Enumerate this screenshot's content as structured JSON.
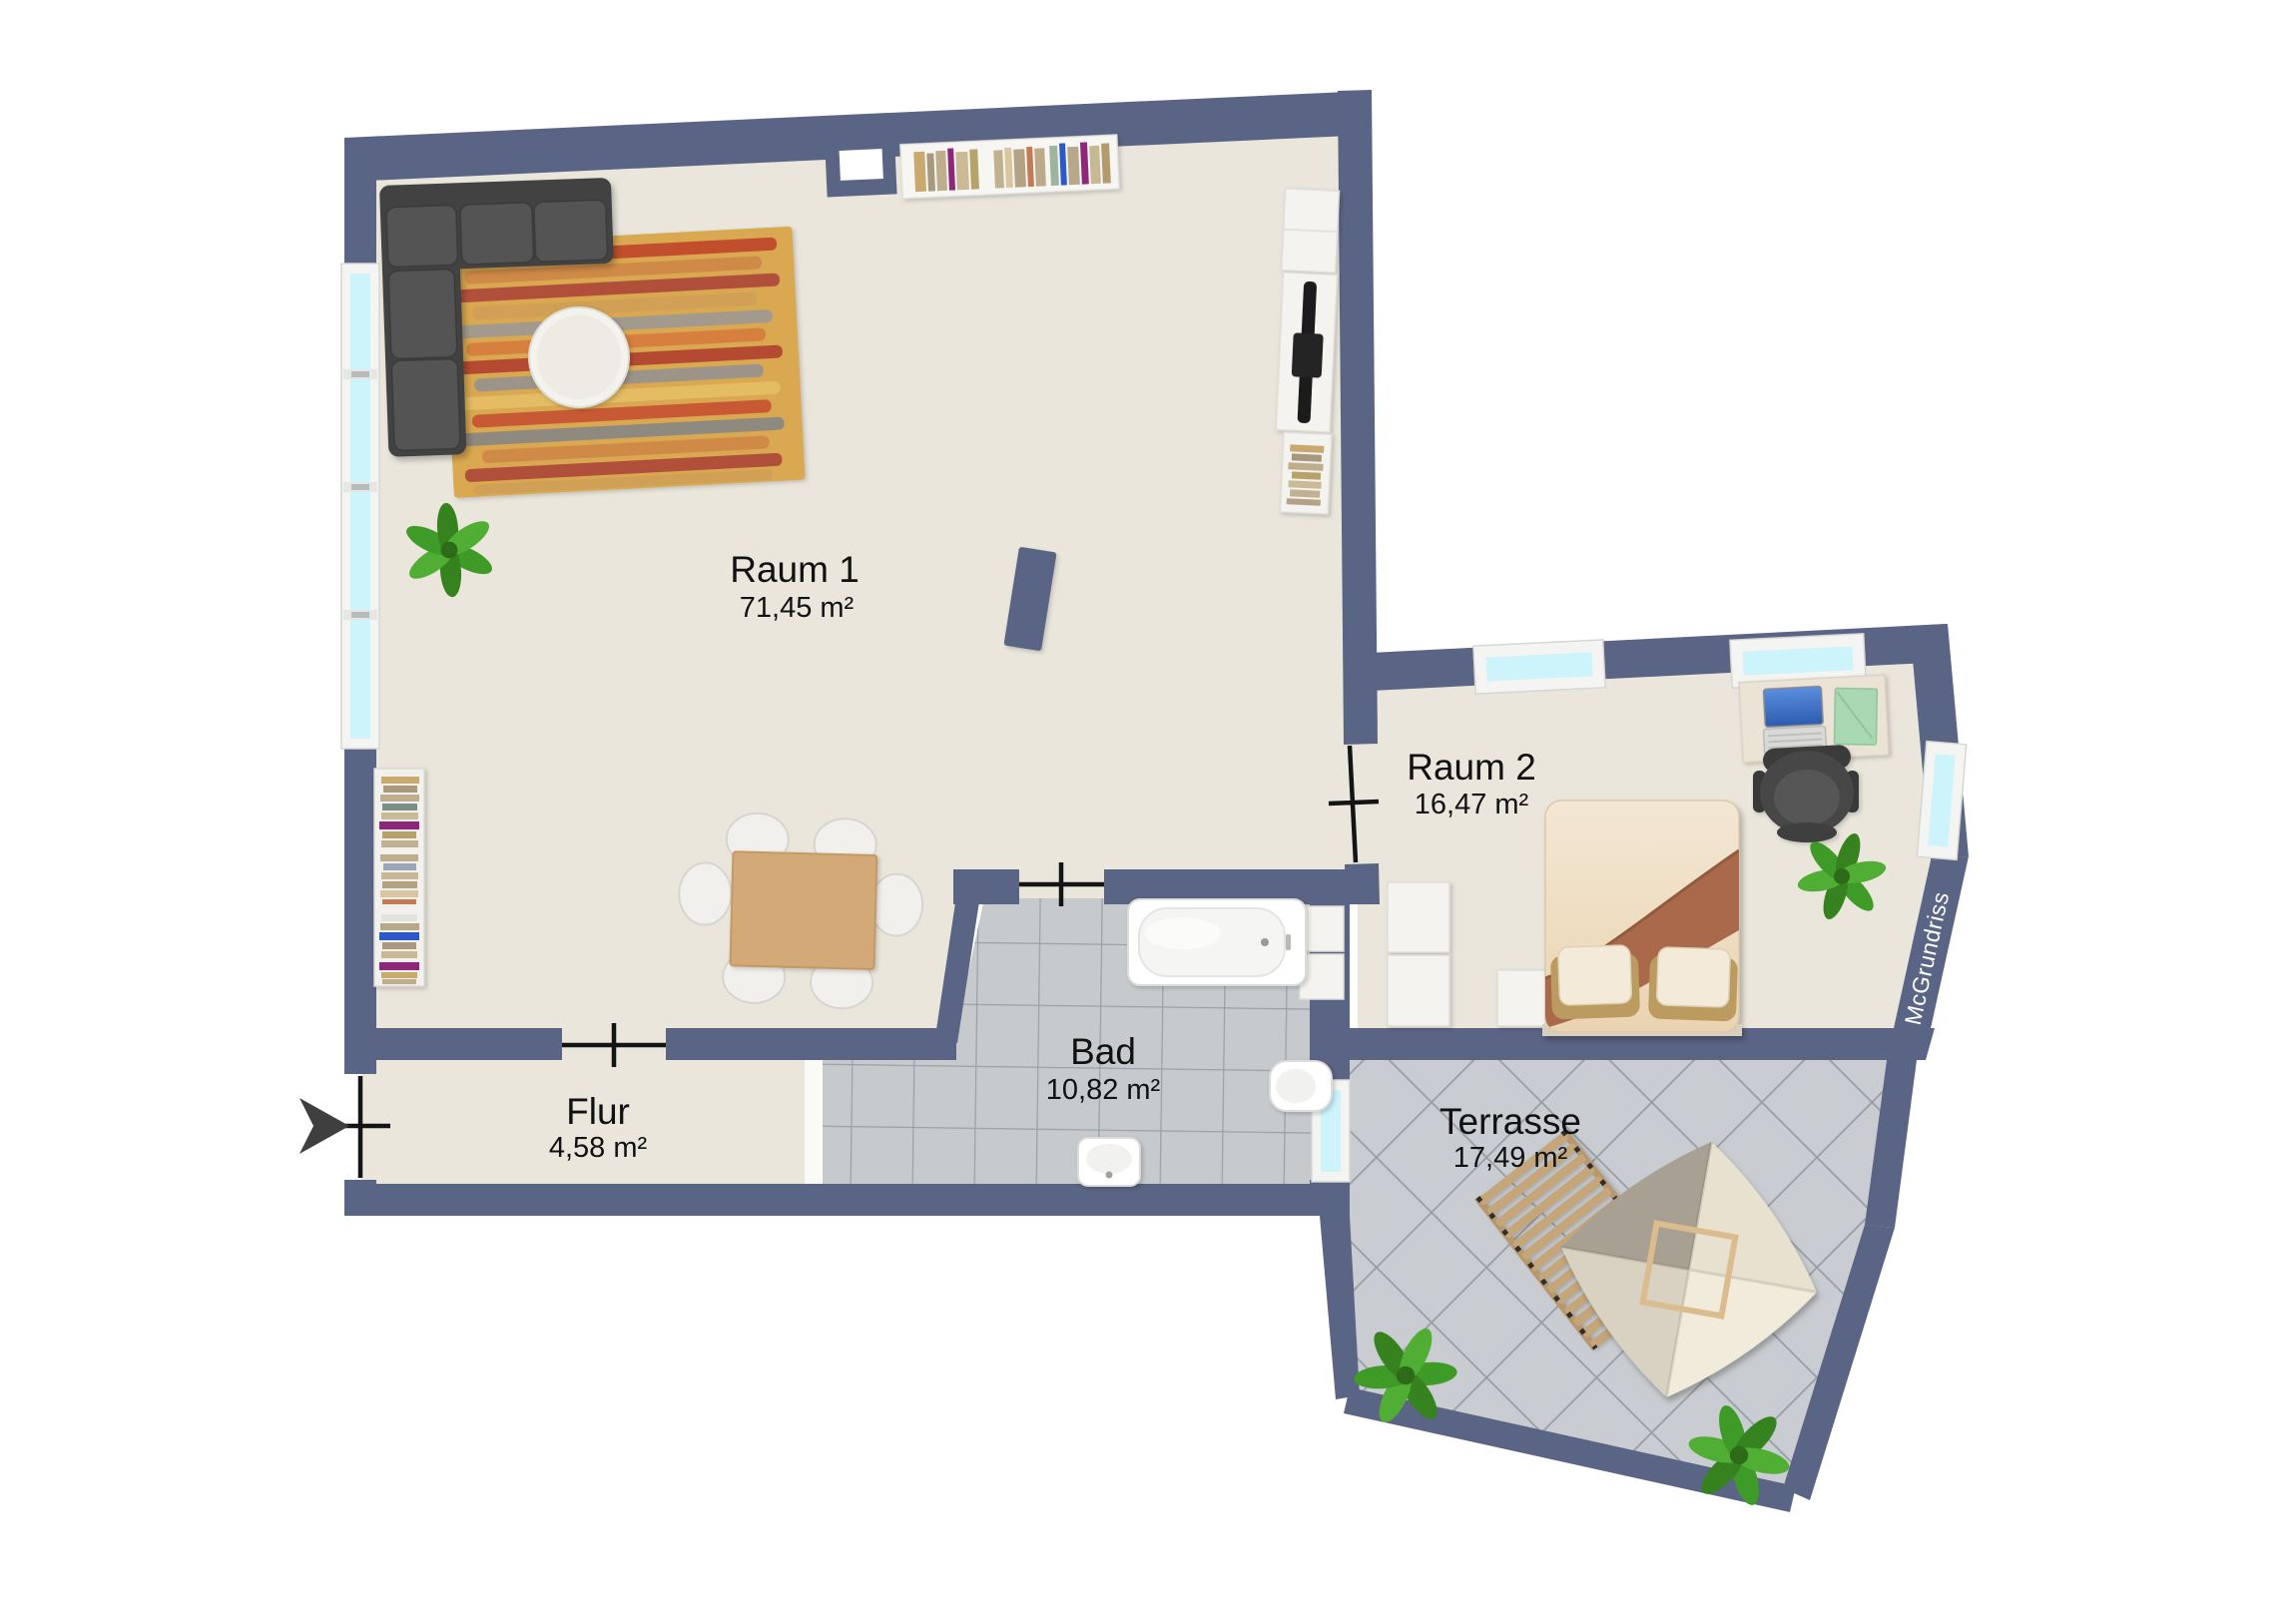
{
  "plan": {
    "watermark": "McGrundriss",
    "rooms": [
      {
        "id": "raum-1",
        "name": "Raum 1",
        "area": "71,45 m²"
      },
      {
        "id": "raum-2",
        "name": "Raum 2",
        "area": "16,47 m²"
      },
      {
        "id": "bad",
        "name": "Bad",
        "area": "10,82 m²"
      },
      {
        "id": "flur",
        "name": "Flur",
        "area": "4,58 m²"
      },
      {
        "id": "terrasse",
        "name": "Terrasse",
        "area": "17,49 m²"
      }
    ],
    "colors": {
      "background": "#ffffff",
      "wall": "#5a6484",
      "floor": "#eae6dc",
      "bath-tile": "#c6cacd",
      "tile-line": "#9aa1a8",
      "terrace-tile": "#c9ccd0",
      "glass": "#ccf4fa",
      "frame": "#f4f4f2",
      "door": "#141414",
      "label": "#111111",
      "sofa": "#4e4e4e",
      "rug": "#d9a850",
      "wood": "#d3aa77",
      "blanket": "#a9694a",
      "plant": "#3d9727",
      "lounger": "#c5a67b",
      "canopy": "#e9e2d2",
      "arrow": "#3f3f3f"
    }
  }
}
